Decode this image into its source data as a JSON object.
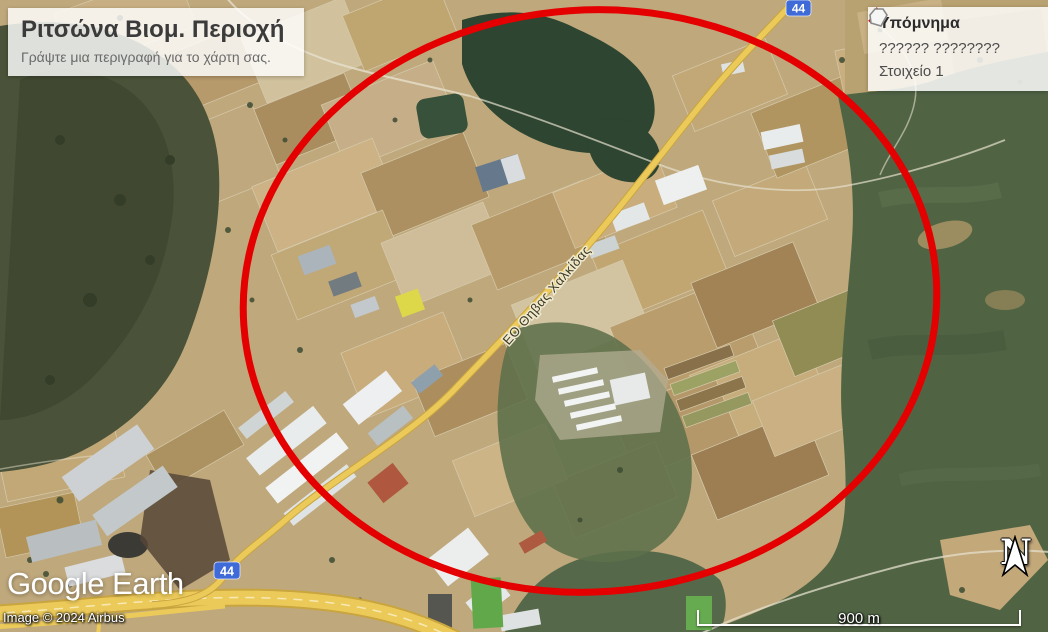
{
  "title_box": {
    "title": "Ριτσώνα Βιομ. Περιοχή",
    "subtitle": "Γράψτε μια περιγραφή για το χάρτη σας."
  },
  "legend": {
    "title": "Υπόμνημα",
    "items": [
      {
        "label": "?????? ????????",
        "icon": "red-vertices-path-icon"
      },
      {
        "label": "Στοιχείο 1",
        "icon": "white-polygon-icon"
      }
    ]
  },
  "map": {
    "road_label": "ΕΟ Θηβας Χαλκίδας",
    "route_shield_top": "44",
    "route_shield_bottom": "44",
    "circle_color": "#e40000",
    "road_color": "#ecca5a",
    "shield_color": "#3f6bd8"
  },
  "footer": {
    "logo": "Google Earth",
    "attribution": "Image © 2024 Airbus",
    "scale_label": "900 m",
    "north_label": "N"
  }
}
